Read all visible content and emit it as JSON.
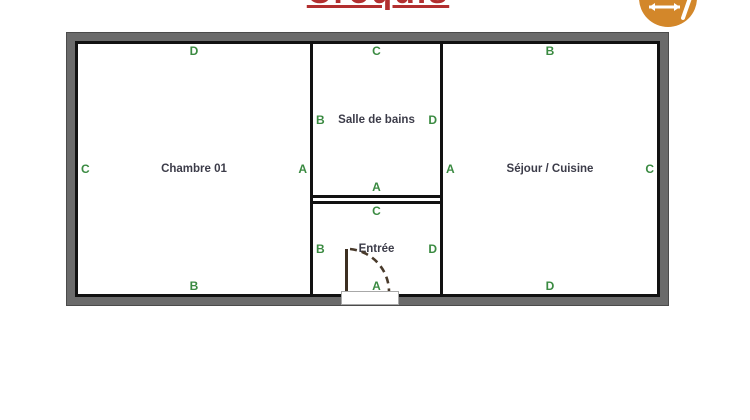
{
  "title": {
    "text": "Croquis",
    "color": "#b22f2f"
  },
  "toolbar": {
    "icon": {
      "name": "sketch-tool",
      "color": "#d3872a",
      "glyph_color": "#ffffff"
    }
  },
  "plan": {
    "label_color": "#3a8a41",
    "wall_color": "#111111",
    "frame_color": "#6b6b6b",
    "rooms": {
      "chambre": {
        "name": "Chambre 01",
        "top": "D",
        "left": "C",
        "right": "A",
        "bottom": "B"
      },
      "salle_de_bains": {
        "name": "Salle de bains",
        "top": "C",
        "left": "B",
        "right": "D",
        "bottom": "A"
      },
      "entree": {
        "name": "Entrée",
        "top": "C",
        "left": "B",
        "right": "D",
        "bottom": "A"
      },
      "sejour": {
        "name": "Séjour / Cuisine",
        "top": "B",
        "left": "A",
        "right": "C",
        "bottom": "D"
      }
    }
  }
}
